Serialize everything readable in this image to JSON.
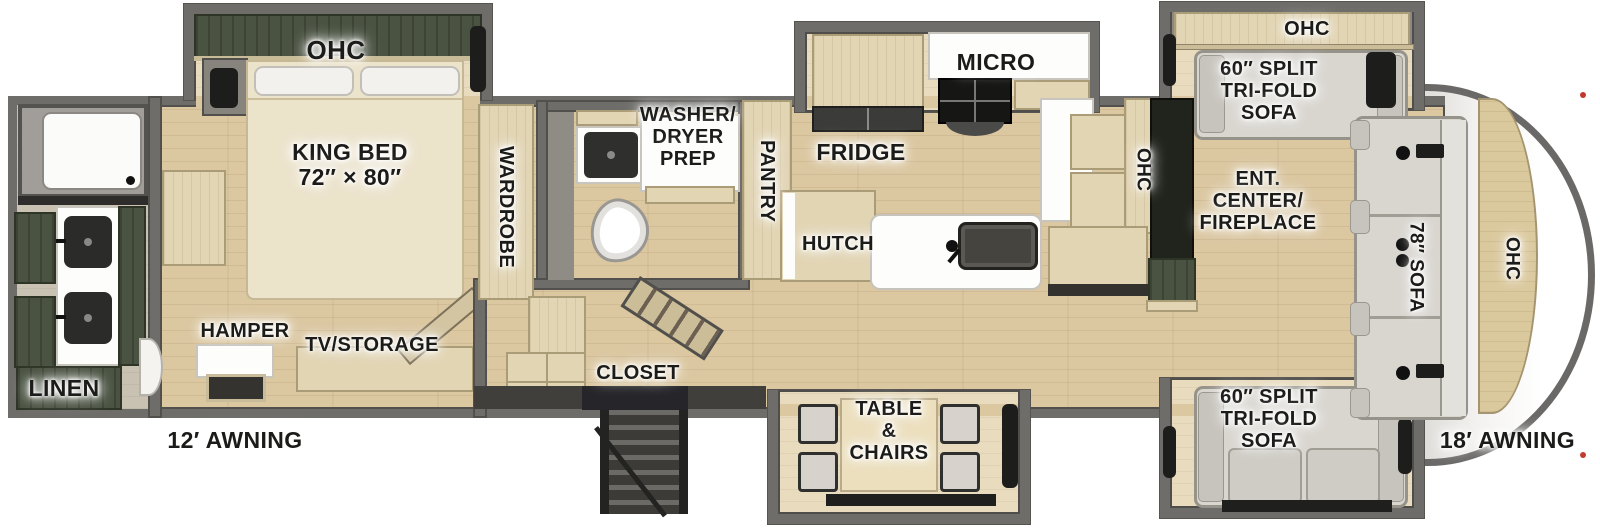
{
  "title": "Fifth Wheel RV Floorplan",
  "colors": {
    "background": "#ffffff",
    "walls": "#6e6d6a",
    "floor_wood": "#dbc7a0",
    "cabinet_tan": "#e2d5b4",
    "cabinet_dark_green": "#4a5342",
    "sofa_gray": "#d9d6d0",
    "counter_white": "#fdfdfc",
    "label_text": "#1b1b19"
  },
  "labels": {
    "ohc_bedroom": "OHC",
    "king_bed": "KING BED\n72″ × 80″",
    "wardrobe": "WARDROBE",
    "washer_dryer_prep": "WASHER/\nDRYER\nPREP",
    "pantry": "PANTRY",
    "micro": "MICRO",
    "fridge": "FRIDGE",
    "hutch": "HUTCH",
    "ohc_kitchen": "OHC",
    "linen": "LINEN",
    "hamper": "HAMPER",
    "tv_storage": "TV/STORAGE",
    "closet": "CLOSET",
    "table_chairs": "TABLE\n&\nCHAIRS",
    "ohc_living": "OHC",
    "sofa_slide_top": "60″ SPLIT\nTRI-FOLD\nSOFA",
    "ent_center": "ENT.\nCENTER/\nFIREPLACE",
    "sofa_front": "78″ SOFA",
    "ohc_front": "OHC",
    "sofa_slide_bottom": "60″ SPLIT\nTRI-FOLD\nSOFA",
    "awning_left": "12′ AWNING",
    "awning_right": "18′ AWNING"
  }
}
